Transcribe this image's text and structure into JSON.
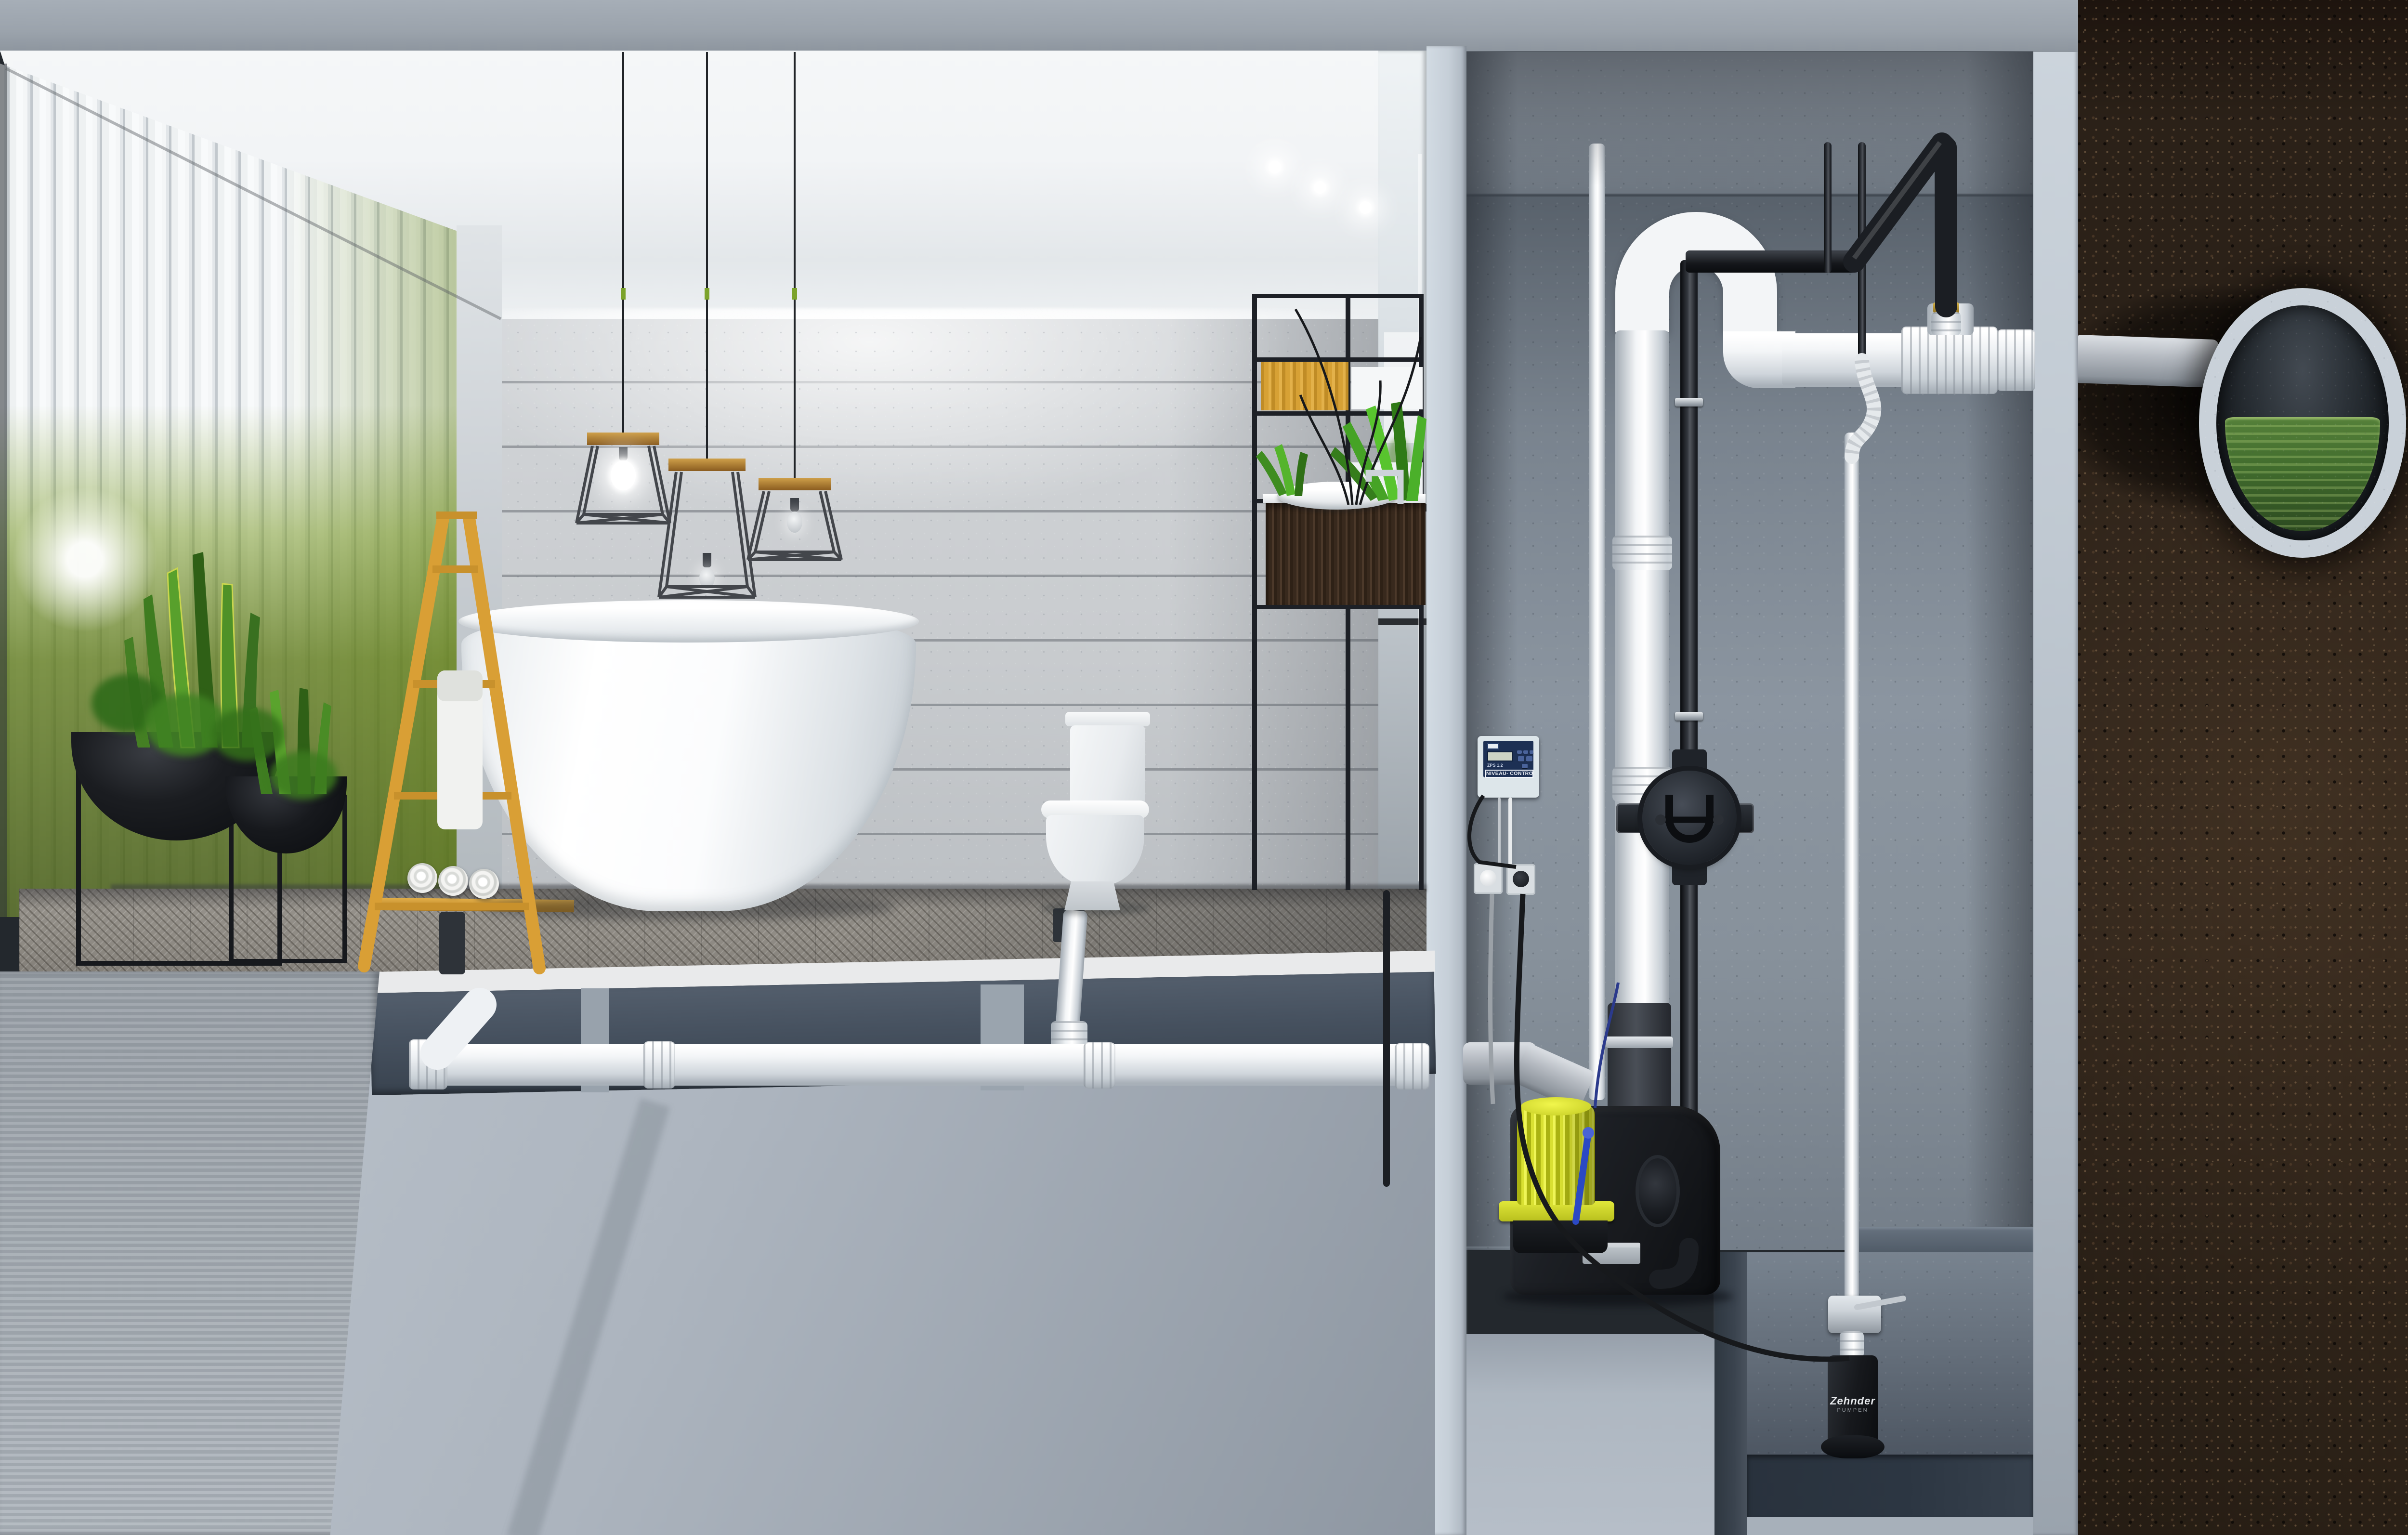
{
  "labels": {
    "controller_ribbon": "NIVEAU- CONTROLLER",
    "controller_model": "ZPS 1.2",
    "pump_brand": "Zehnder",
    "pump_brand_sub": "PUMPEN"
  },
  "colors": {
    "concrete-top": "#9ba3ac",
    "ceiling-white": "#f2f4f6",
    "board-wall": "#c9cccf",
    "slat-white": "#eef1f2",
    "green-glow": "#7e9c2e",
    "floor-wood": "#8e8a83",
    "screed": "#e9eaeb",
    "infill-dark": "#46515f",
    "slab-light": "#b3bbc5",
    "divider-cut": "#c6cfd8",
    "shaft-wall": "#7e8893",
    "shaft-floor": "#46515e",
    "pit-floor": "#2c3642",
    "pipe-white": "#f3f5f7",
    "pipe-gray": "#b5bac1",
    "pipe-black": "#202329",
    "tank-black": "#17191d",
    "motor-yellow": "#d9e032",
    "handle-blue": "#2b49c4",
    "controller-case": "#dde6ea",
    "controller-panel": "#1d3054",
    "ladder-wood": "#d99f35",
    "vanity-wood": "#38291d",
    "panel-wood": "#d7a135",
    "plant-green": "#4e8f27",
    "soil-dark": "#281e16",
    "sewer-ring": "#c9d1d9",
    "water-green": "#416c2d",
    "chrome": "#cdd3d9"
  }
}
